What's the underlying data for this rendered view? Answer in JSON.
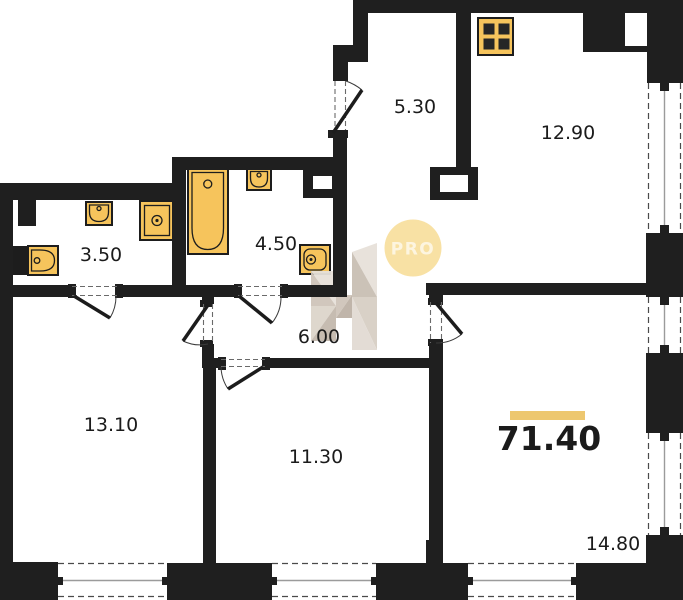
{
  "rooms": [
    {
      "area": "5.30"
    },
    {
      "area": "12.90"
    },
    {
      "area": "3.50"
    },
    {
      "area": "4.50"
    },
    {
      "area": "6.00"
    },
    {
      "area": "13.10"
    },
    {
      "area": "11.30"
    },
    {
      "area": "14.80"
    }
  ],
  "total": {
    "area": "71.40"
  },
  "watermark": {
    "badge": "PRO"
  },
  "icons": [
    "stove-icon",
    "kitchen-sink-icon",
    "bathtub-icon",
    "sink-icon",
    "washing-machine-icon",
    "wash-basin-icon",
    "toilet-icon",
    "faceted-h-logo"
  ],
  "colors": {
    "wall": "#1f1f1f",
    "fixture_fill": "#f6c45c",
    "accent_bar": "#edc76f",
    "pro_circle": "#f8e1a4",
    "logo_beige": "#d6cdc3",
    "window_glass": "#9b9b9b"
  }
}
